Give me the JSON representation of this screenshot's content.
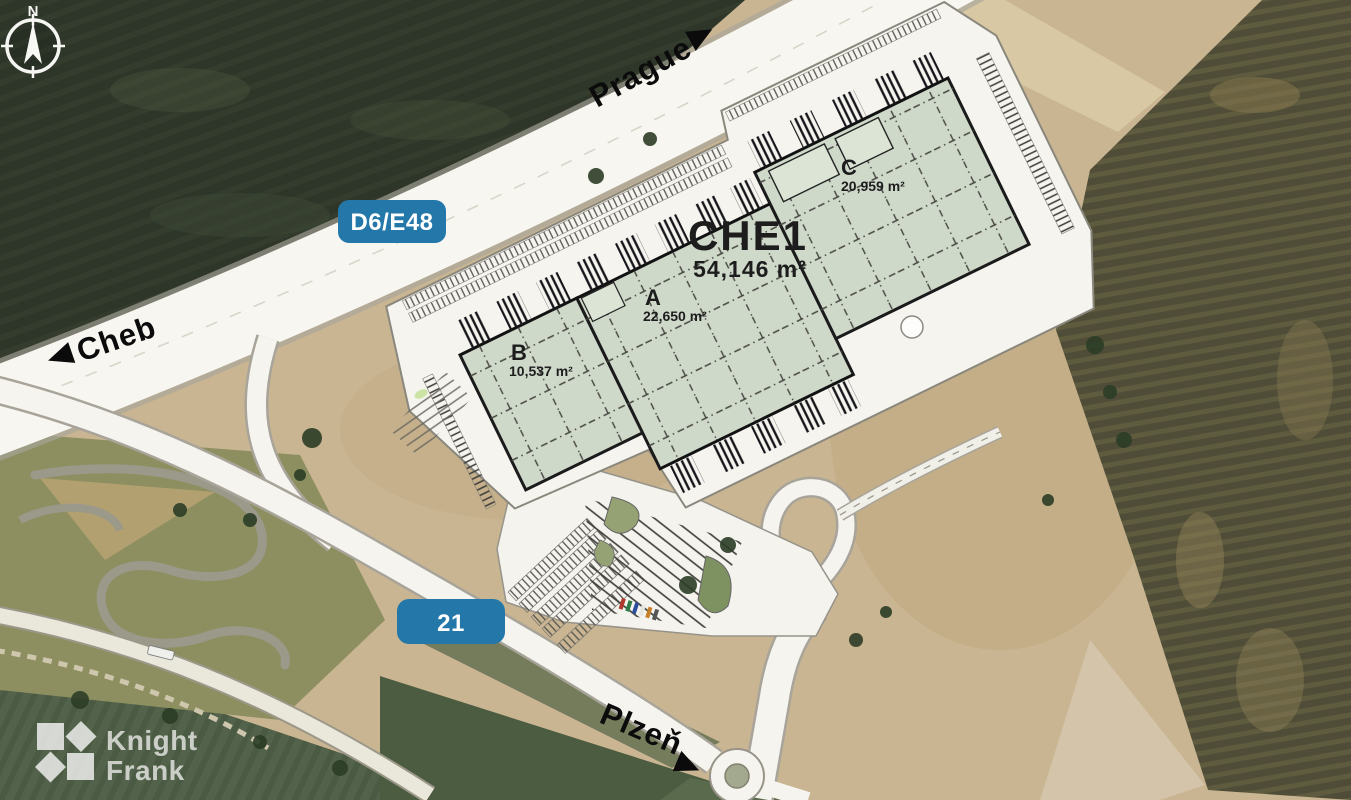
{
  "map": {
    "compass_north": "N",
    "road_labels": {
      "prague": "Prague",
      "cheb": "Cheb",
      "plzen": "Plzeň"
    },
    "route_badges": {
      "motorway": "D6/E48",
      "route21": "21"
    },
    "site": {
      "name": "CHE1",
      "total_area": "54,146 m²",
      "units": [
        {
          "label": "A",
          "area": "22,650 m²"
        },
        {
          "label": "B",
          "area": "10,537 m²"
        },
        {
          "label": "C",
          "area": "20,959 m²"
        }
      ]
    },
    "branding": {
      "line1": "Knight",
      "line2": "Frank"
    },
    "colors": {
      "route_badge_blue": "#2377a9",
      "building_fill_green": "#cfd9ca",
      "road_white": "#f7f6f1",
      "field_dark_green": "#2f372b",
      "field_brown": "#514f38",
      "soil_tan": "#c9b592"
    }
  }
}
